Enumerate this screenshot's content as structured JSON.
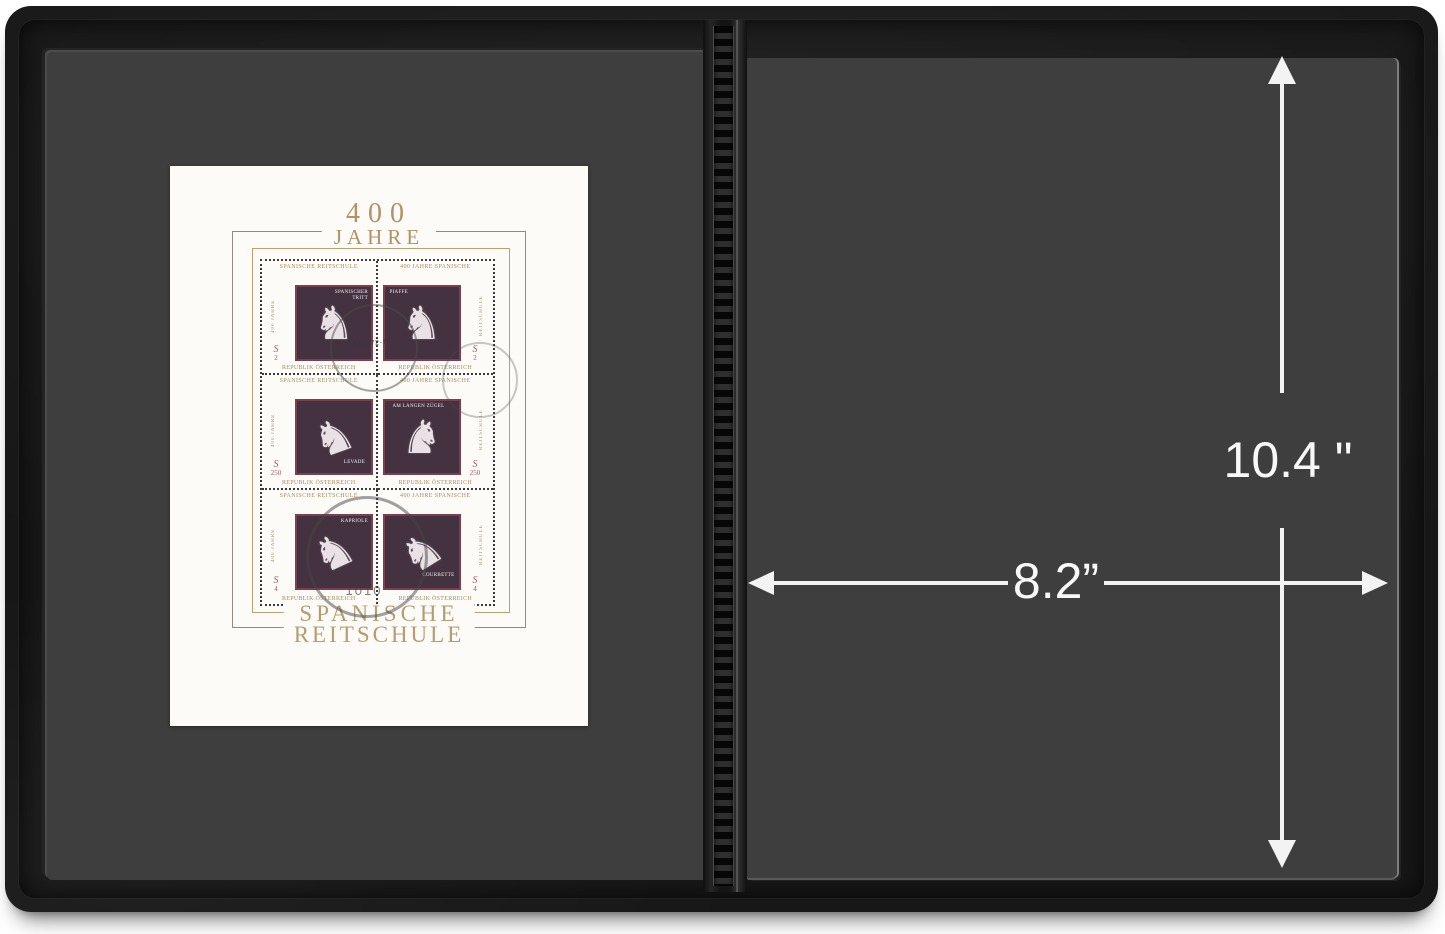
{
  "dimensions": {
    "height_label": "10.4 \"",
    "width_label": "8.2”"
  },
  "stamp_sheet": {
    "title_top_line1": "400",
    "title_top_line2": "JAHRE",
    "title_bottom_line1": "SPANISCHE",
    "title_bottom_line2": "REITSCHULE",
    "margin_top_left_cell": "SPANISCHE REITSCHULE",
    "margin_top_right_cell": "400 JAHRE SPANISCHE",
    "margin_bottom_cell": "REPUBLIK ÖSTERREICH",
    "margin_vertical_left": "400 JAHRE",
    "margin_vertical_right": "REITSCHULE",
    "stamps": [
      {
        "name": "SPANISCHER TRITT",
        "currency": "S",
        "value": "2"
      },
      {
        "name": "PIAFFE",
        "currency": "S",
        "value": "2"
      },
      {
        "name": "LEVADE",
        "currency": "S",
        "value": "250"
      },
      {
        "name": "AM LANGEN ZÜGEL",
        "currency": "S",
        "value": "250"
      },
      {
        "name": "KAPRIOLE",
        "currency": "S",
        "value": "4"
      },
      {
        "name": "COURBETTE",
        "currency": "S",
        "value": "4"
      }
    ],
    "postmark": {
      "code": "1010",
      "date": "12.9.72-13"
    }
  },
  "icons": {
    "horse_glyph": "♞"
  },
  "colors": {
    "cover_black": "#171717",
    "page_gray": "#3e3e3e",
    "sheet_white": "#fcfbf8",
    "gold": "#b09366",
    "stamp_plum": "#443240",
    "stamp_frame_red": "#7b3f4f",
    "denomination_red": "#a2596a",
    "annotation_white": "#f3f3f3"
  }
}
